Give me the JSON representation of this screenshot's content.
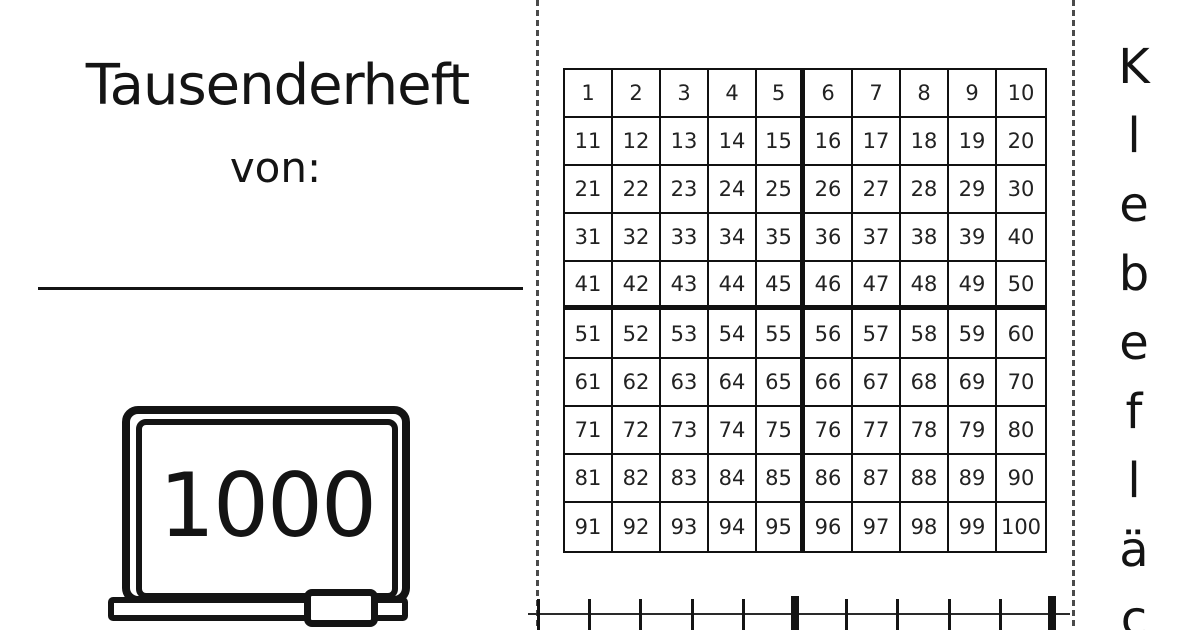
{
  "page": {
    "background": "#ffffff",
    "ink_color": "#141414",
    "dash_color": "#4a4a4a"
  },
  "cover": {
    "title": "Tausenderheft",
    "from_label": "von:",
    "board_number": "1000"
  },
  "hundred_chart": {
    "rows": 10,
    "cols": 10,
    "thick_after_col": 5,
    "thick_after_row": 5,
    "numbers": [
      1,
      2,
      3,
      4,
      5,
      6,
      7,
      8,
      9,
      10,
      11,
      12,
      13,
      14,
      15,
      16,
      17,
      18,
      19,
      20,
      21,
      22,
      23,
      24,
      25,
      26,
      27,
      28,
      29,
      30,
      31,
      32,
      33,
      34,
      35,
      36,
      37,
      38,
      39,
      40,
      41,
      42,
      43,
      44,
      45,
      46,
      47,
      48,
      49,
      50,
      51,
      52,
      53,
      54,
      55,
      56,
      57,
      58,
      59,
      60,
      61,
      62,
      63,
      64,
      65,
      66,
      67,
      68,
      69,
      70,
      71,
      72,
      73,
      74,
      75,
      76,
      77,
      78,
      79,
      80,
      81,
      82,
      83,
      84,
      85,
      86,
      87,
      88,
      89,
      90,
      91,
      92,
      93,
      94,
      95,
      96,
      97,
      98,
      99,
      100
    ]
  },
  "glue_area": {
    "visible_letters": [
      "K",
      "l",
      "e",
      "b",
      "e",
      "f",
      "l",
      "ä",
      "c"
    ]
  },
  "number_line": {
    "tick_count": 11,
    "major_tick_indices": [
      5,
      10
    ]
  }
}
